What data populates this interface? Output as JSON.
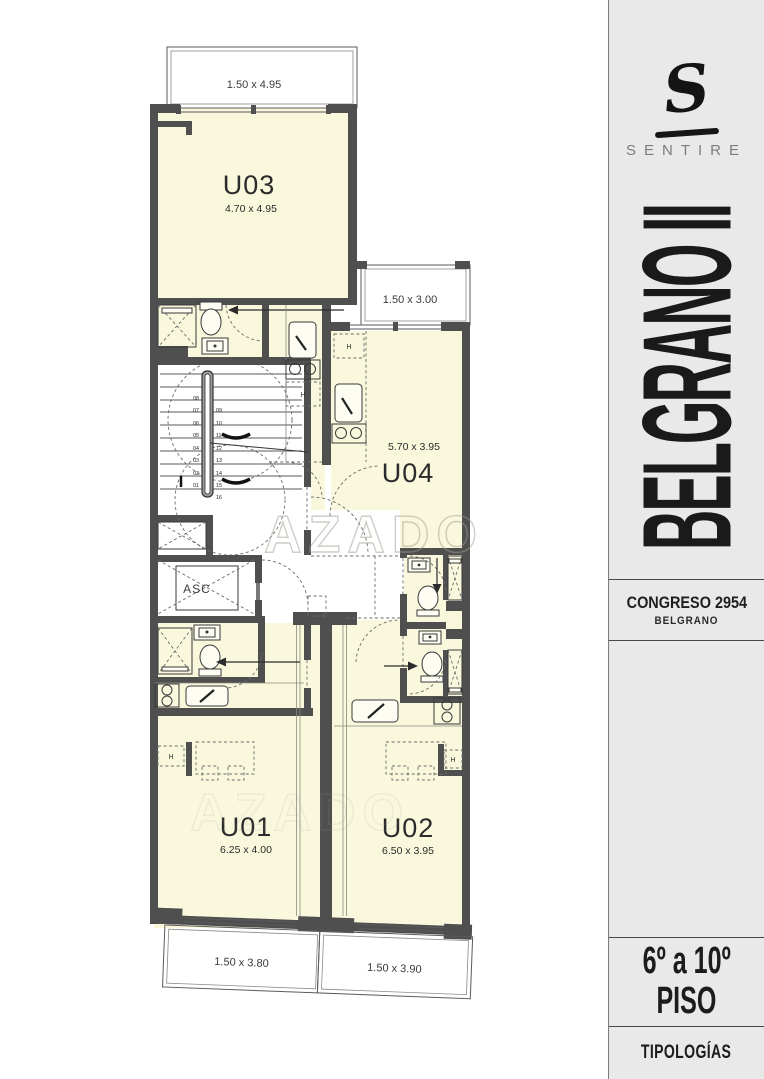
{
  "sidebar": {
    "logo_initial": "S",
    "brand": "SENTIRE",
    "project": "BELGRANO II",
    "address_line1": "CONGRESO 2954",
    "address_line2": "BELGRANO",
    "floors_line1": "6º a 10º",
    "floors_line2": "PISO",
    "footer": "TIPOLOGÍAS"
  },
  "plan": {
    "watermark": "AZADO",
    "elevator_label": "ASC",
    "closet_label": "H",
    "units": [
      {
        "label": "U03",
        "dims": "4.70 x 4.95"
      },
      {
        "label": "U04",
        "dims": "5.70 x 3.95"
      },
      {
        "label": "U01",
        "dims": "6.25 x 4.00"
      },
      {
        "label": "U02",
        "dims": "6.50 x 3.95"
      }
    ],
    "balconies": [
      {
        "dims": "1.50 x 4.95"
      },
      {
        "dims": "1.50 x 3.00"
      },
      {
        "dims": "1.50 x 3.80"
      },
      {
        "dims": "1.50 x 3.90"
      }
    ],
    "stair_numbers_left": [
      "08",
      "07",
      "06",
      "05",
      "04",
      "03",
      "02",
      "01"
    ],
    "stair_numbers_right": [
      "09",
      "10",
      "11",
      "12",
      "13",
      "14",
      "15",
      "16"
    ]
  },
  "colors": {
    "wall": "#4f4f4f",
    "unit_fill": "#f9f7dc",
    "balcony_stripe": "#e7e4c2",
    "sidebar_bg": "#e9e9e9"
  }
}
